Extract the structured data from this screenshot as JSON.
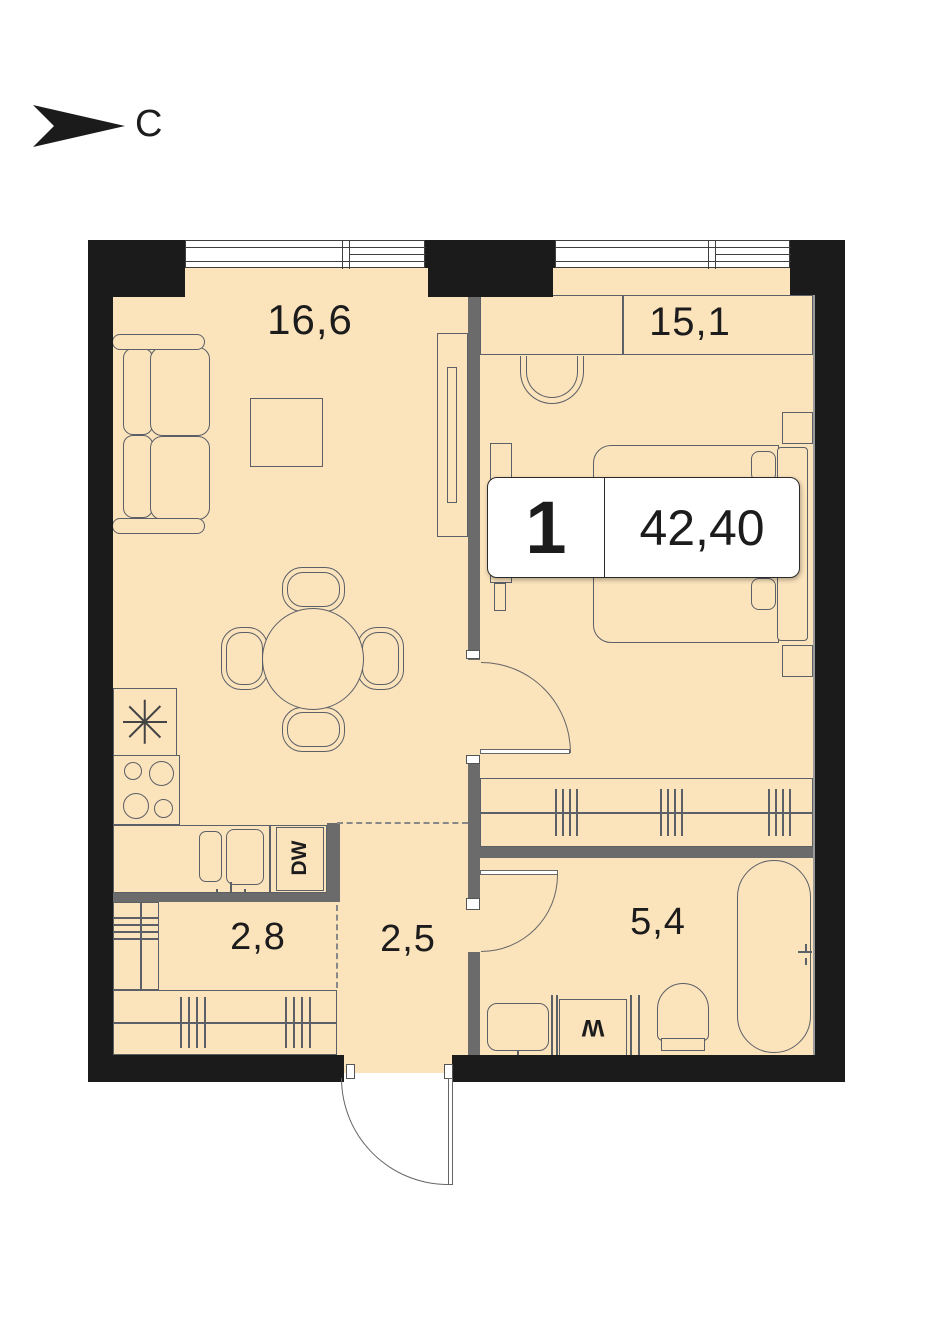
{
  "compass": {
    "label": "С"
  },
  "unit_badge": {
    "rooms_count": "1",
    "area_total": "42,40"
  },
  "rooms": [
    {
      "name": "living-kitchen",
      "area": "16,6"
    },
    {
      "name": "bedroom",
      "area": "15,1"
    },
    {
      "name": "hallway",
      "area": "2,8"
    },
    {
      "name": "corridor",
      "area": "2,5"
    },
    {
      "name": "bathroom",
      "area": "5,4"
    }
  ],
  "appliances": {
    "dishwasher_label": "DW",
    "washer_label": "W"
  },
  "colors": {
    "wall": "#1b1b1b",
    "partition": "#6b6b6b",
    "floor": "#fbe3bc",
    "outline": "#5b5f66",
    "text": "#1c1c1c"
  }
}
